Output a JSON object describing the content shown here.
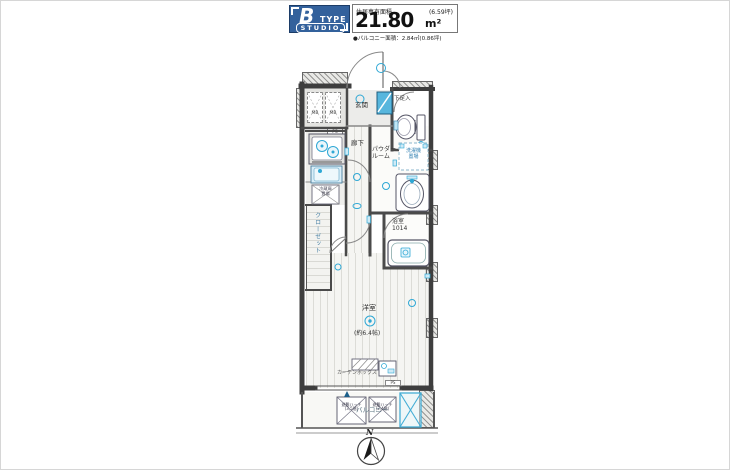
{
  "header": {
    "type_letter": "B",
    "type_word": "TYPE",
    "studio_label": "STUDIO",
    "area_title": "住居専有面積",
    "area_tsubo": "(6.59坪)",
    "area_value": "21.80",
    "area_unit": "m²",
    "balcony_note": "●バルコニー面積：2.84㎡(0.86坪)"
  },
  "plan": {
    "rooms": {
      "genkan": "玄関",
      "hallway": "廊下",
      "powder_line1": "パウダー",
      "powder_line2": "ルーム",
      "bath": "浴室",
      "bath_size": "1014",
      "main_room": "洋室",
      "main_room_size": "(約6.4帖)",
      "closet": "クローゼット",
      "balcony": "バルコニー"
    },
    "fixtures": {
      "shoe_box": "下足入",
      "washer_line1": "洗濯機",
      "washer_line2": "置場",
      "fridge_line1": "冷蔵庫",
      "fridge_line2": "置場",
      "curtain_box": "カーテンボックス",
      "mb_left": "MB",
      "mb_right": "MB",
      "ps_top": "PS",
      "ps_balcony": "PS",
      "hatch1_line1": "避難ハッチ",
      "hatch1_line2": "(3,5階)",
      "hatch2_line1": "避難ハッチ",
      "hatch2_line2": "(2,4階)"
    },
    "compass_n": "N"
  },
  "colors": {
    "header_blue": "#33619c",
    "fixture_cyan": "#2fa8d5",
    "wall_gray": "#3e3e3e"
  }
}
